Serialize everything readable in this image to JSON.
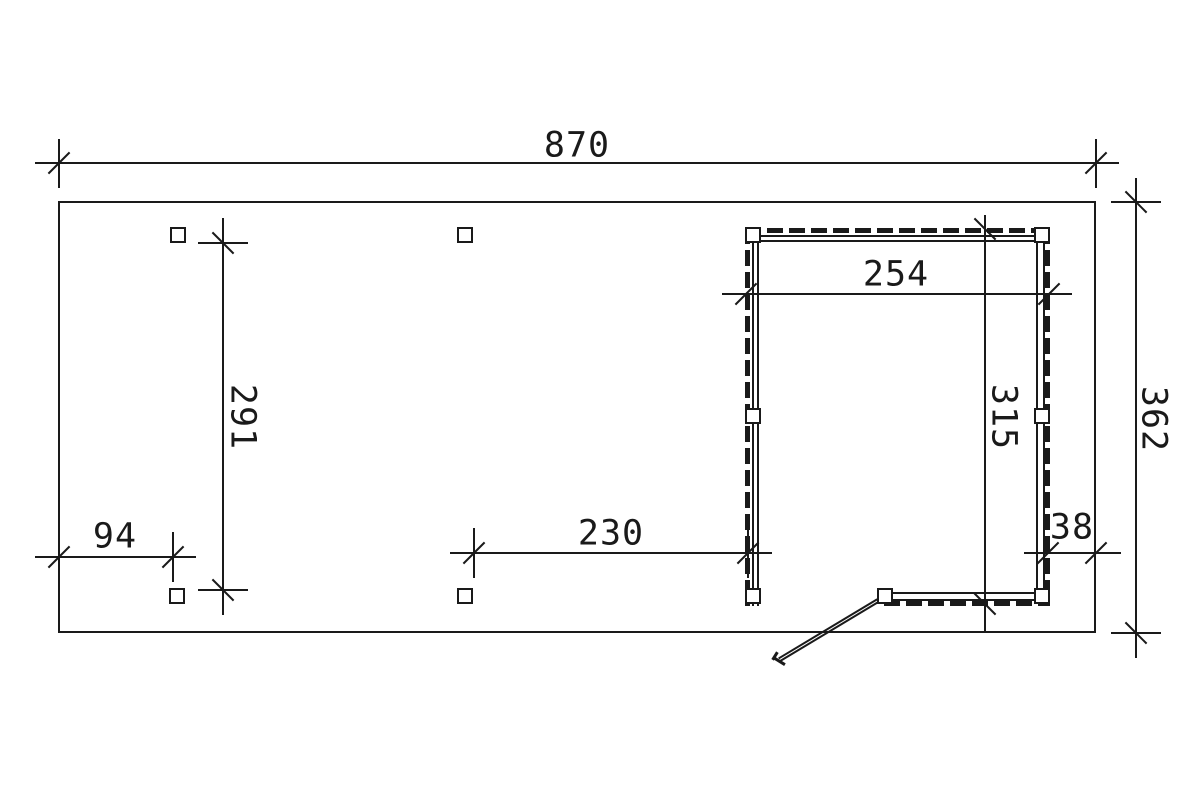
{
  "plan": {
    "colors": {
      "ink": "#1a1a1a",
      "paper": "#ffffff"
    },
    "dimensions": {
      "total_width": "870",
      "total_depth": "362",
      "left_post_span": "291",
      "left_offset": "94",
      "middle_span": "230",
      "right_offset": "38",
      "shed_width": "254",
      "shed_depth": "315"
    }
  }
}
